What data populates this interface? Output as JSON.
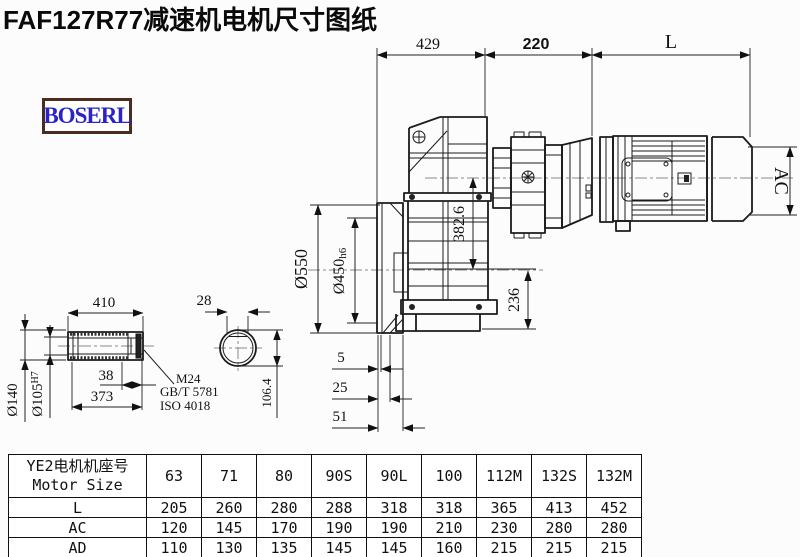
{
  "title": "FAF127R77减速机电机尺寸图纸",
  "logo": "BOSERL",
  "colors": {
    "line": "#1b1b1b",
    "logo_text": "#2a24c8",
    "logo_border": "#4b2c21",
    "background": "#fcfcfc"
  },
  "drawing": {
    "dims": {
      "top1": "429",
      "top2": "220",
      "top3": "L",
      "motor_od": "AC",
      "flange_od": "Ø550",
      "spigot": "Ø450",
      "spigot_tol": "h6",
      "center_to_base": "382.6",
      "base": "236",
      "off1": "5",
      "off2": "25",
      "off3": "51",
      "shaft_total": "410",
      "hub_width": "38",
      "shaft_len": "373",
      "bore_od": "Ø140",
      "bore": "Ø105",
      "bore_tol": "H7",
      "key_width": "28",
      "flat": "106.4",
      "thread": "M24",
      "std1": "GB/T 5781",
      "std2": "ISO 4018"
    }
  },
  "table": {
    "header_cn": "YE2电机机座号",
    "header_en": "Motor Size",
    "columns": [
      "63",
      "71",
      "80",
      "90S",
      "90L",
      "100",
      "112M",
      "132S",
      "132M"
    ],
    "rows": [
      {
        "label": "L",
        "values": [
          "205",
          "260",
          "280",
          "288",
          "318",
          "318",
          "365",
          "413",
          "452"
        ]
      },
      {
        "label": "AC",
        "values": [
          "120",
          "145",
          "170",
          "190",
          "190",
          "210",
          "230",
          "280",
          "280"
        ]
      },
      {
        "label": "AD",
        "values": [
          "110",
          "130",
          "135",
          "145",
          "145",
          "160",
          "215",
          "215",
          "215"
        ]
      }
    ]
  }
}
